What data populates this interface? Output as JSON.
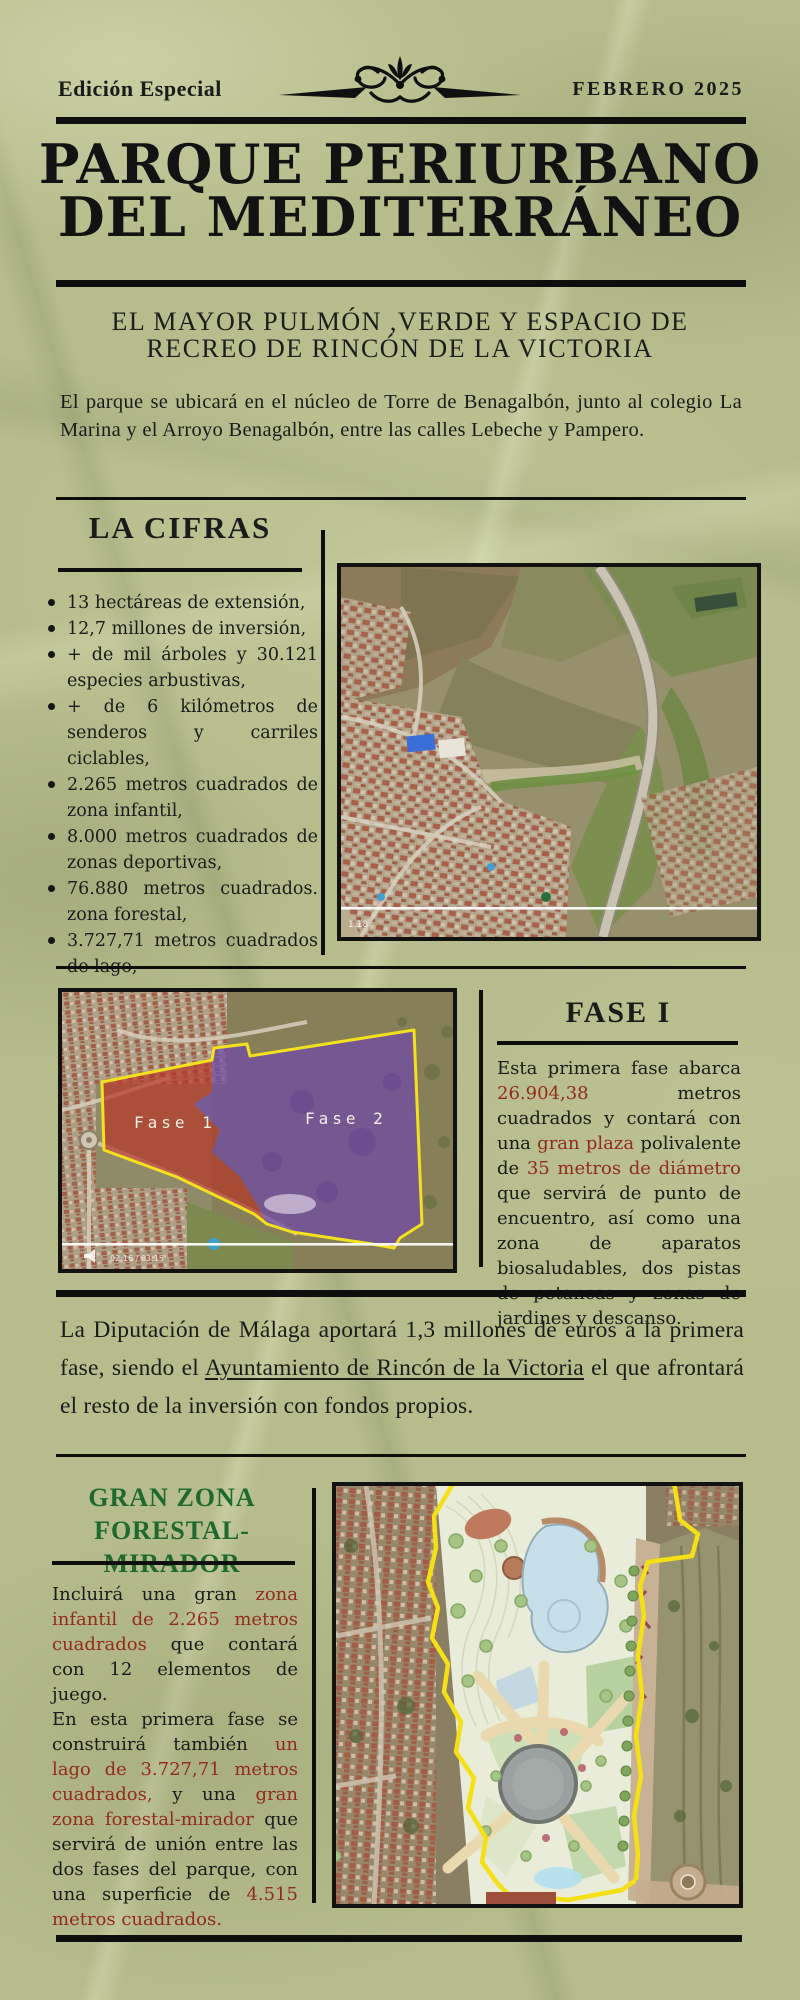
{
  "colors": {
    "paper": "#b6bc8b",
    "ink": "#1b1b1b",
    "accent_red": "#932b1d",
    "accent_green": "#1e6a2e",
    "rule_black": "#0e0e0e",
    "map_outline_yellow": "#f2e11c",
    "fase1_overlay_red": "#b63828",
    "fase2_overlay_purple": "#6f4ba6"
  },
  "masthead": {
    "edition": "Edición Especial",
    "date": "FEBRERO 2025",
    "ornament": "fleuron-flourish"
  },
  "title": {
    "line1": "PARQUE PERIURBANO",
    "line2": "DEL MEDITERRÁNEO"
  },
  "intro": {
    "subtitle_line1": "EL MAYOR PULMÓN ,VERDE Y ESPACIO DE",
    "subtitle_line2": "RECREO DE RINCÓN DE LA VICTORIA",
    "paragraph": "El parque se ubicará en el núcleo de Torre de Benagalbón, junto al colegio La Marina y el Arroyo Benagalbón, entre las calles Lebeche y Pampero."
  },
  "cifras": {
    "heading": "LA CIFRAS",
    "items": [
      "13 hectáreas de extensión,",
      "12,7 millones de inversión,",
      "+ de mil árboles y 30.121 especies arbustivas,",
      "+ de 6 kilómetros de senderos y carriles ciclables,",
      "2.265 metros cuadrados de zona infantil,",
      "8.000 metros cuadrados de zonas deportivas,",
      "76.880 metros cuadrados. zona forestal,",
      "3.727,71 metros cuadrados de lago,"
    ],
    "map": {
      "video_time": "1:18"
    }
  },
  "fase1": {
    "heading": "FASE I",
    "paragraph": [
      {
        "t": "Esta primera fase abarca "
      },
      {
        "t": "26.904,38",
        "c": "red"
      },
      {
        "t": " metros cuadrados y contará con una "
      },
      {
        "t": "gran plaza",
        "c": "red"
      },
      {
        "t": " polivalente de "
      },
      {
        "t": "35 metros de diámetro",
        "c": "red"
      },
      {
        "t": " que servirá de punto de encuentro, así como una zona de aparatos biosaludables, dos pistas de petancas y zonas de jardines y descanso."
      }
    ],
    "map": {
      "label_fase1": "Fase 1",
      "label_fase2": "Fase 2",
      "video_time": "02:16 / 03:15"
    }
  },
  "funding": {
    "paragraph": [
      {
        "t": "La Diputación de Málaga aportará 1,3 millones de euros a la primera fase, siendo el "
      },
      {
        "t": "Ayuntamiento de Rincón de la Victoria",
        "u": true
      },
      {
        "t": " el que afrontará el resto de la inversión con fondos propios."
      }
    ]
  },
  "granzona": {
    "heading_line1": "GRAN ZONA",
    "heading_line2": "FORESTAL-MIRADOR",
    "paragraph": [
      {
        "t": "Incluirá una gran "
      },
      {
        "t": "zona infantil de 2.265 metros cuadrados",
        "c": "red"
      },
      {
        "t": " que contará con 12 elementos de juego.\nEn esta primera fase se construirá también "
      },
      {
        "t": "un lago de 3.727,71 metros cuadrados,",
        "c": "red"
      },
      {
        "t": " y una "
      },
      {
        "t": "gran zona forestal-mirador",
        "c": "red"
      },
      {
        "t": " que servirá de unión entre las dos fases del parque, con una superficie de "
      },
      {
        "t": "4.515 metros cuadrados.",
        "c": "red"
      }
    ]
  }
}
